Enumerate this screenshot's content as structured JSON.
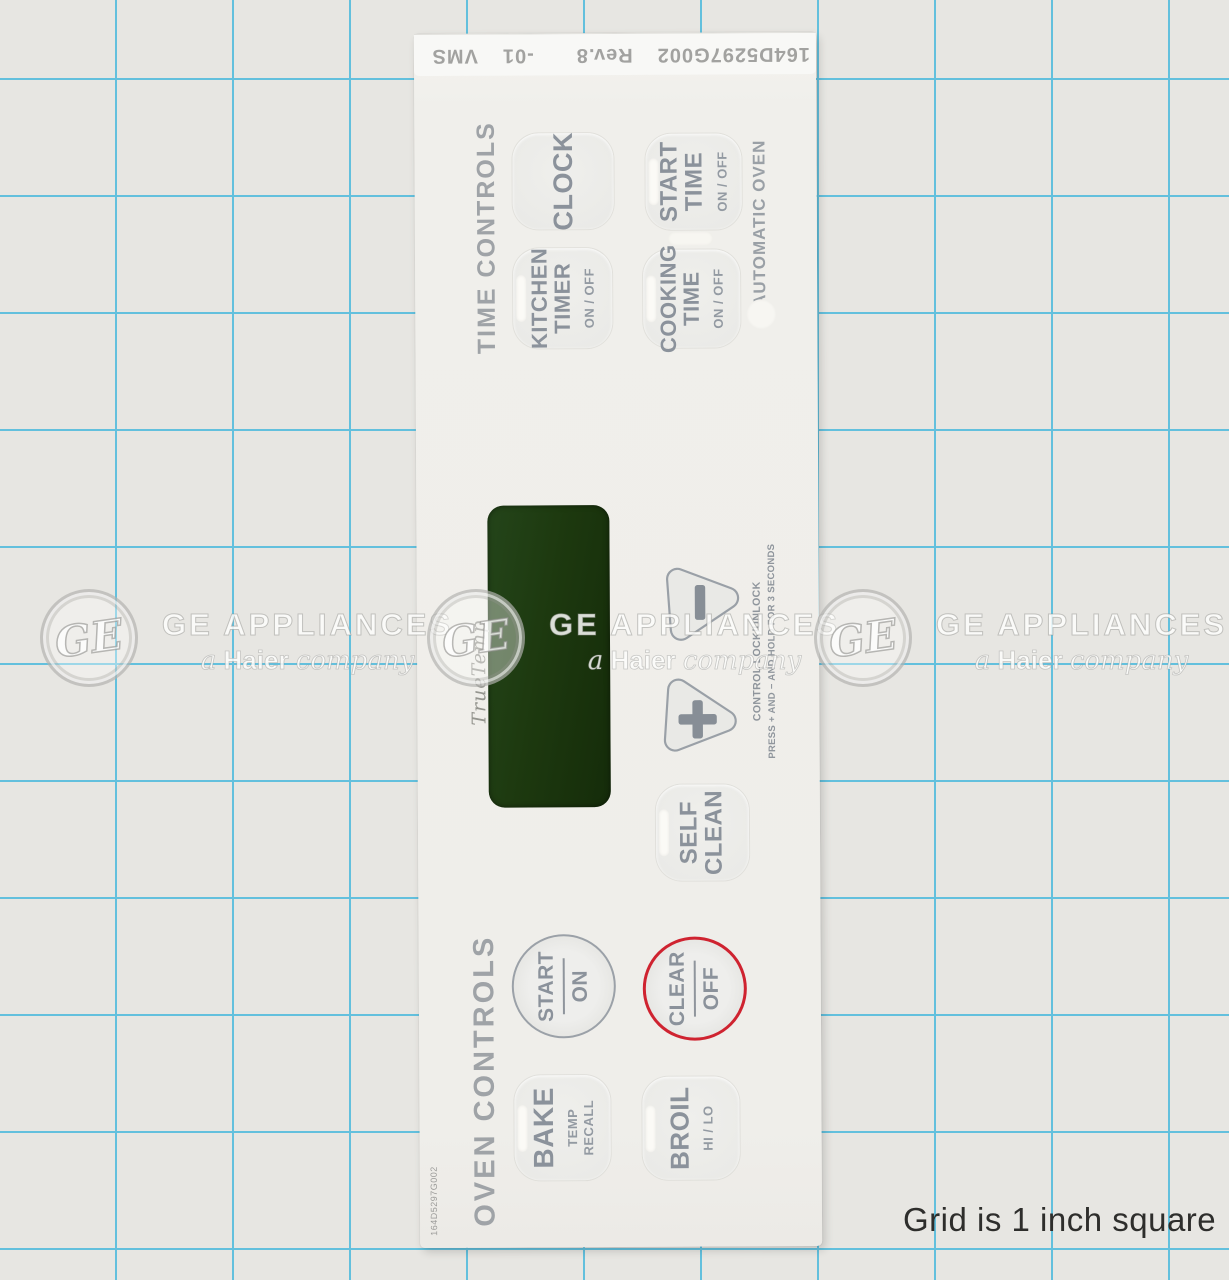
{
  "photo": {
    "caption": "Grid is 1 inch square"
  },
  "watermark": {
    "monogram": "GE",
    "brand": "GE APPLIANCES",
    "tagline": {
      "a": "a",
      "haier": "Haier",
      "company": "company"
    }
  },
  "panel": {
    "part_strip": {
      "part": "164D5297G002",
      "rev": "Rev.8",
      "dash": "-01",
      "vms": "VMS"
    },
    "side_part_number": "164D5297G002",
    "labels": {
      "time_controls": "TIME CONTROLS",
      "oven_controls": "OVEN CONTROLS",
      "automatic_oven": "AUTOMATIC OVEN",
      "display_brand": "TrueTemp"
    },
    "lock_note": {
      "line1": "CONTROL LOCK/UNLOCK",
      "line2": "PRESS + AND − AND HOLD FOR 3 SECONDS"
    },
    "keys": {
      "clock": {
        "line1": "CLOCK"
      },
      "kitchen_timer": {
        "line1": "KITCHEN",
        "line2": "TIMER",
        "sub": "ON / OFF"
      },
      "start_time": {
        "line1": "START",
        "line2": "TIME",
        "sub": "ON / OFF"
      },
      "cooking_time": {
        "line1": "COOKING",
        "line2": "TIME",
        "sub": "ON / OFF"
      },
      "self_clean": {
        "line1": "SELF",
        "line2": "CLEAN"
      },
      "bake": {
        "line1": "BAKE",
        "sub1": "TEMP",
        "sub2": "RECALL"
      },
      "broil": {
        "line1": "BROIL",
        "sub": "HI / LO"
      },
      "start_on": {
        "top": "START",
        "bottom": "ON"
      },
      "clear_off": {
        "top": "CLEAR",
        "bottom": "OFF"
      },
      "minus": {
        "icon": "minus-icon"
      },
      "plus": {
        "icon": "plus-icon"
      }
    },
    "colors": {
      "display_green": "#1d390f",
      "clear_ring_red": "#cf2330",
      "key_text_gray": "#8b929b",
      "grid_blue": "#63c0dd"
    }
  }
}
